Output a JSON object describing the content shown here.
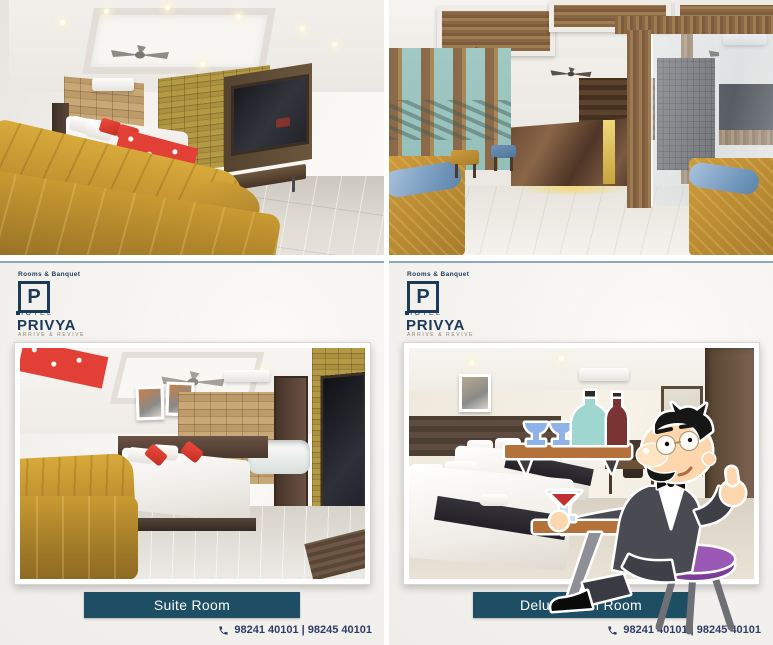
{
  "brand": {
    "category": "Rooms & Banquet",
    "monogram": "P",
    "hotel_word": "HOTEL",
    "name": "PRIVYA",
    "tagline": "ARRIVE & REVIVE"
  },
  "card_left": {
    "room_label": "Suite Room",
    "phone_numbers": "98241 40101 | 98245 40101"
  },
  "card_right": {
    "room_label": "Deluxe Twin Room",
    "phone_numbers": "98241 40101 | 98245 40101"
  },
  "photos": {
    "top_left": "suite-room-with-mustard-sofa-and-tv-wall",
    "top_right": "hotel-lobby-with-marble-reception-desk",
    "bottom_left": "suite-room-framed-photo",
    "bottom_right": "deluxe-twin-room-framed-photo-with-cartoon-waiter"
  },
  "colors": {
    "brand_navy": "#1c3a57",
    "button_teal": "#1d4e63",
    "phone_text": "#2e3d63",
    "card_background": "#f4f2ef",
    "sofa_mustard": "#c5992f",
    "gold_panel": "#ac9140",
    "pillow_red": "#e23a30",
    "pillow_blue": "#7da3c8",
    "stool_purple": "#9b59b6"
  }
}
